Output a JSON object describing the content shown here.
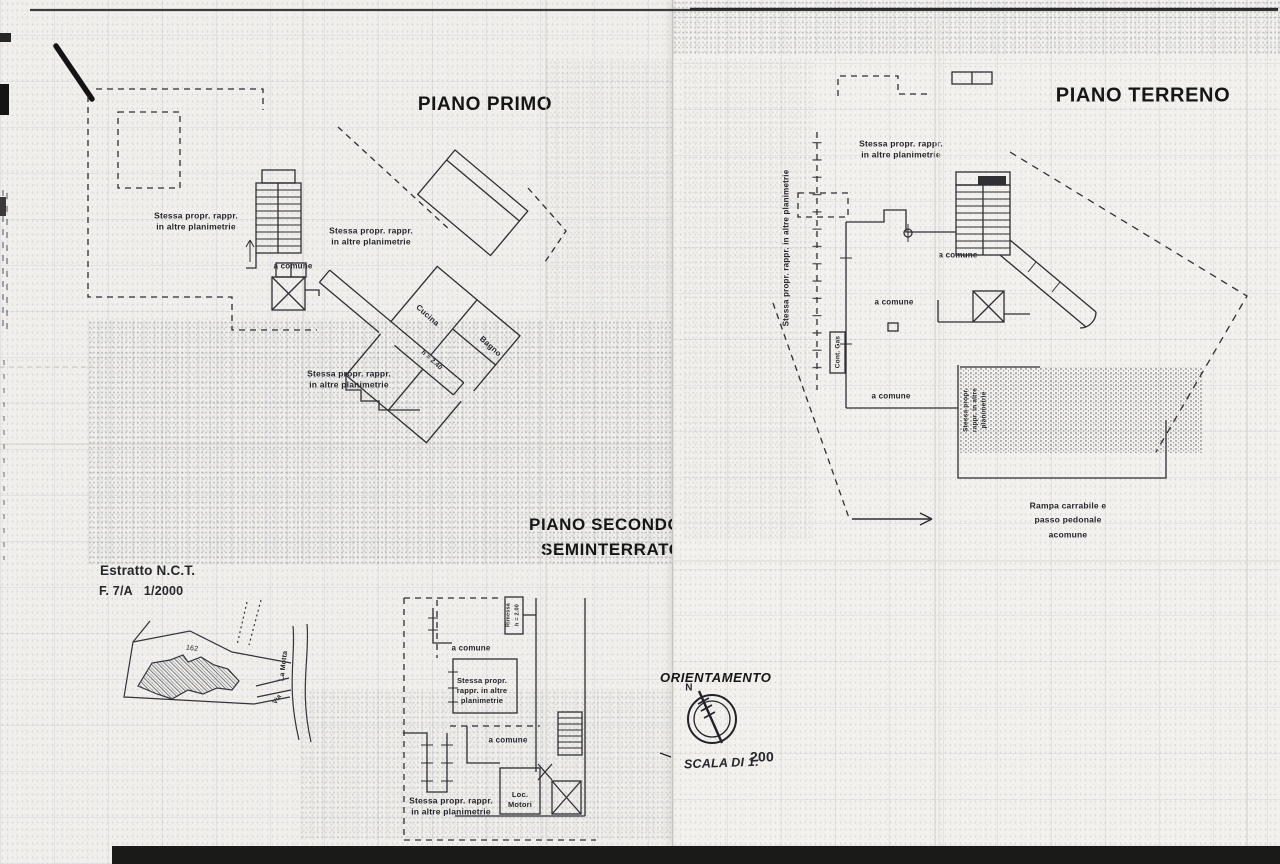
{
  "sheet": {
    "ink_color": "#2e2e33",
    "paper_color": "#f0efeb"
  },
  "piano_primo": {
    "title": "PIANO PRIMO",
    "label_stessa_upper_left": "Stessa propr. rappr.\nin altre planimetrie",
    "label_stessa_center": "Stessa propr. rappr.\nin altre planimetrie",
    "label_a_comune": "a comune",
    "room_cucina": "Cucina",
    "room_bagno": "Bagno",
    "room_height": "h = 2.40",
    "label_stessa_lower": "Stessa propr. rappr.\nin altre planimetrie"
  },
  "piano_secondo_seminterrato": {
    "title_line1": "PIANO SECONDO",
    "title_line2": "SEMINTERRATO",
    "label_rimessa": "Rimessa\nh = 2.00",
    "label_a_comune_upper": "a comune",
    "label_stessa_mid": "Stessa propr.\nrappr. in altre\nplanimetrie",
    "label_a_comune_lower": "a comune",
    "label_loc_motori": "Loc.\nMotori",
    "label_stessa_bottom": "Stessa propr. rappr.\nin altre planimetrie"
  },
  "estratto_nct": {
    "title": "Estratto N.C.T.",
    "reference": "F. 7/A   1/2000",
    "parcel_number": "162",
    "street_name": "La Motta",
    "street_prefix": "Via"
  },
  "piano_terreno": {
    "title": "PIANO TERRENO",
    "label_stessa_vertical": "Stessa propr. rappr. in altre planimetrie",
    "label_stessa_upper": "Stessa propr. rappr.\nin altre planimetrie",
    "label_a_comune_1": "a comune",
    "label_a_comune_2": "a comune",
    "label_cont_gas": "Cont. Gas",
    "label_a_comune_3": "a comune",
    "label_stessa_small_vertical": "Stessa propr.\nrappr. in altre\nplanimetrie",
    "label_rampa": "Rampa carrabile e\npasso pedonale\nacomune"
  },
  "legend": {
    "orientamento_title": "ORIENTAMENTO",
    "compass_north": "N",
    "scale_label": "SCALA DI 1:",
    "scale_value": "200"
  }
}
